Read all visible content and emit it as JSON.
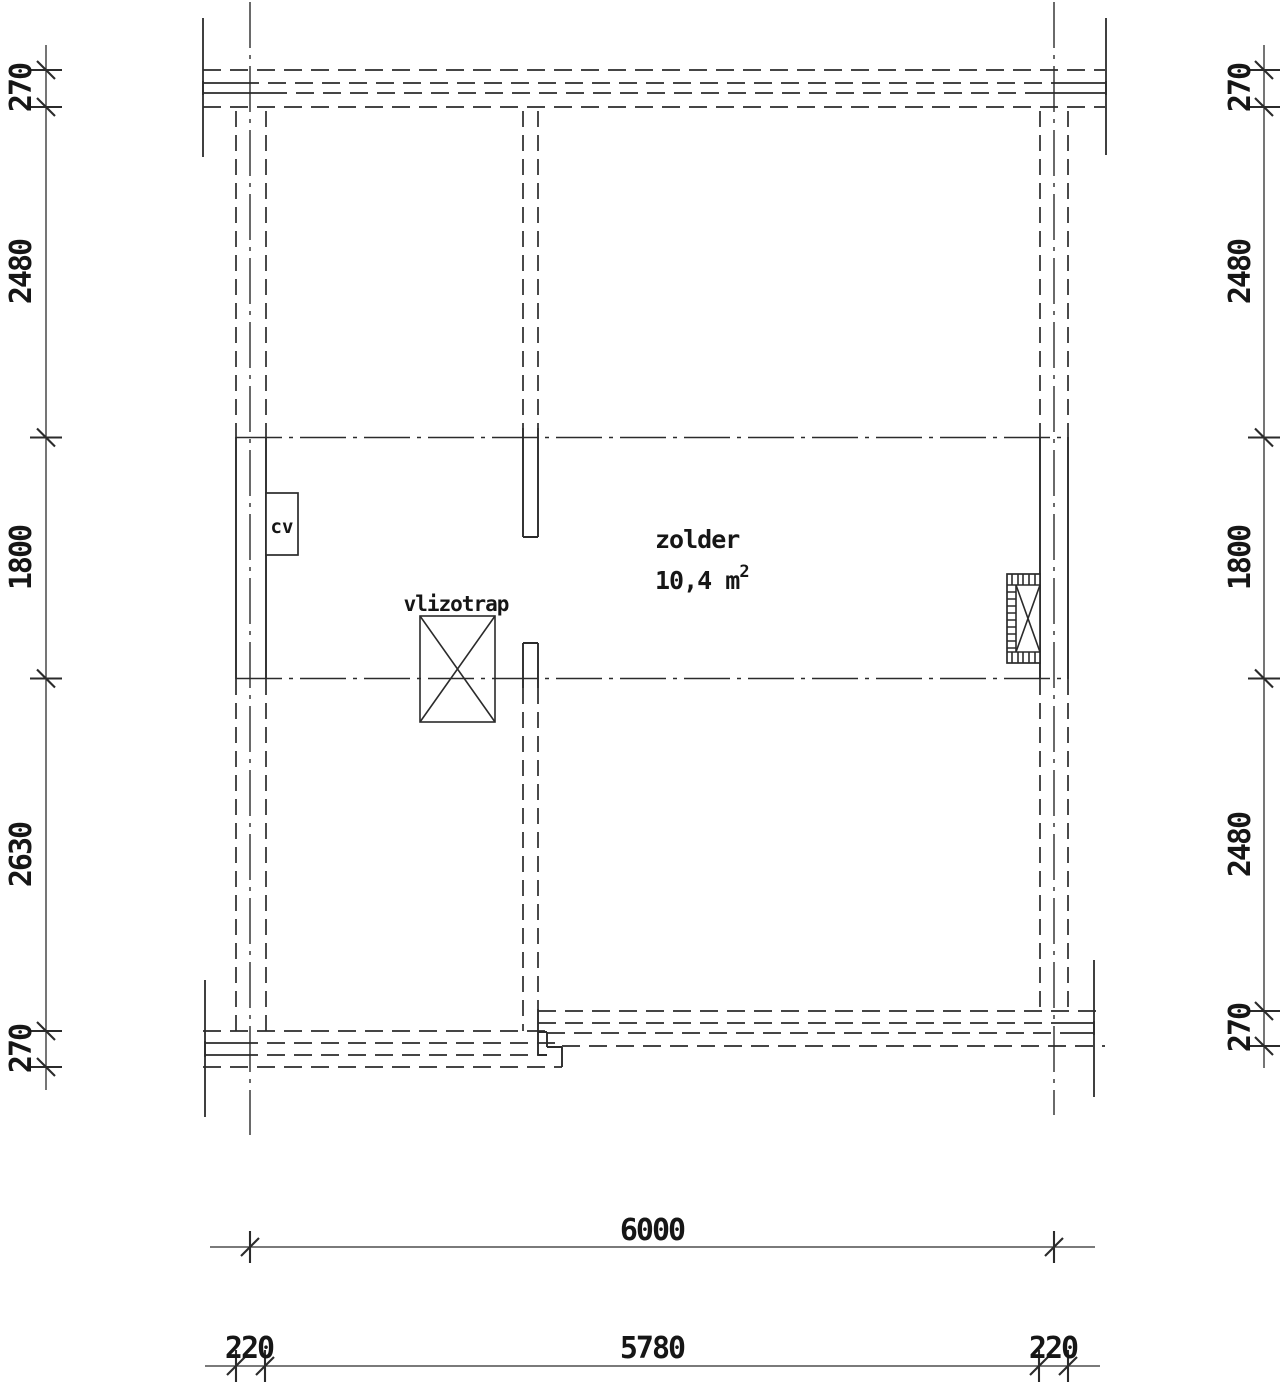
{
  "room": {
    "name": "zolder",
    "area_value": "10,4 m",
    "area_exponent": "2"
  },
  "labels": {
    "hatch": "vlizotrap",
    "boiler": "cv"
  },
  "dimensions": {
    "left": [
      "270",
      "2480",
      "1800",
      "2630",
      "270"
    ],
    "right": [
      "270",
      "2480",
      "1800",
      "2480",
      "270"
    ],
    "bottom_total": "6000",
    "bottom_parts": [
      "220",
      "5780",
      "220"
    ]
  },
  "colors": {
    "line": "#2b2b2b",
    "background": "#ffffff"
  }
}
